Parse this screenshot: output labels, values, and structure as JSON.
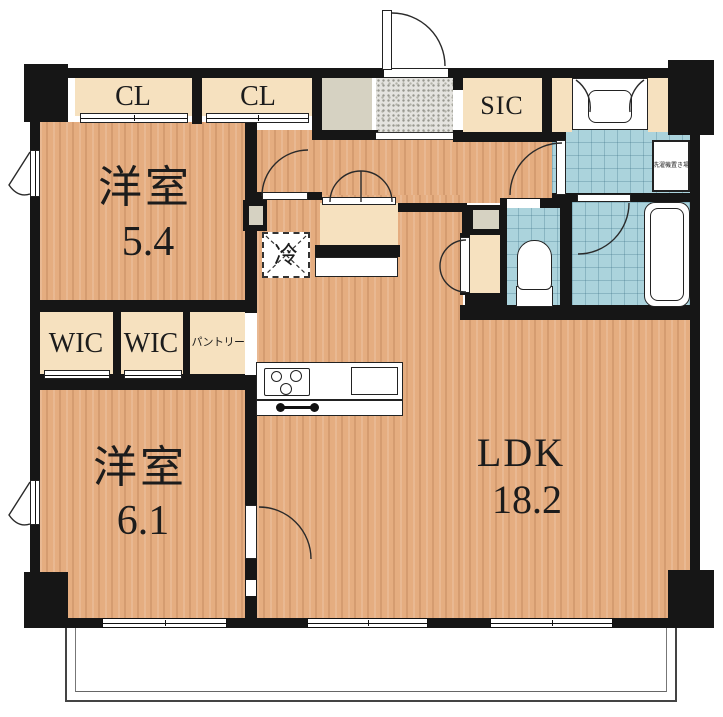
{
  "rooms": {
    "bedroom1": {
      "name": "洋室",
      "size": "5.4"
    },
    "bedroom2": {
      "name": "洋室",
      "size": "6.1"
    },
    "ldk": {
      "name": "LDK",
      "size": "18.2"
    },
    "closet_top_left": {
      "label": "CL"
    },
    "closet_top_right": {
      "label": "CL"
    },
    "shoe_in_closet": {
      "label": "SIC"
    },
    "walk_in_closet_1": {
      "label": "WIC"
    },
    "walk_in_closet_2": {
      "label": "WIC"
    },
    "pantry": {
      "label": "パントリー"
    },
    "refrigerator_space": {
      "label": "冷"
    },
    "washer_space": {
      "label": "洗濯機置き場"
    }
  },
  "colors": {
    "wall": "#161616",
    "wood": "#e5ad80",
    "wet_tile": "#abd3dc",
    "closet": "#f6e1bf",
    "entry_tile": "#e4e3df",
    "pipe_space": "#d6d2c2",
    "fixture": "#ffffff"
  }
}
